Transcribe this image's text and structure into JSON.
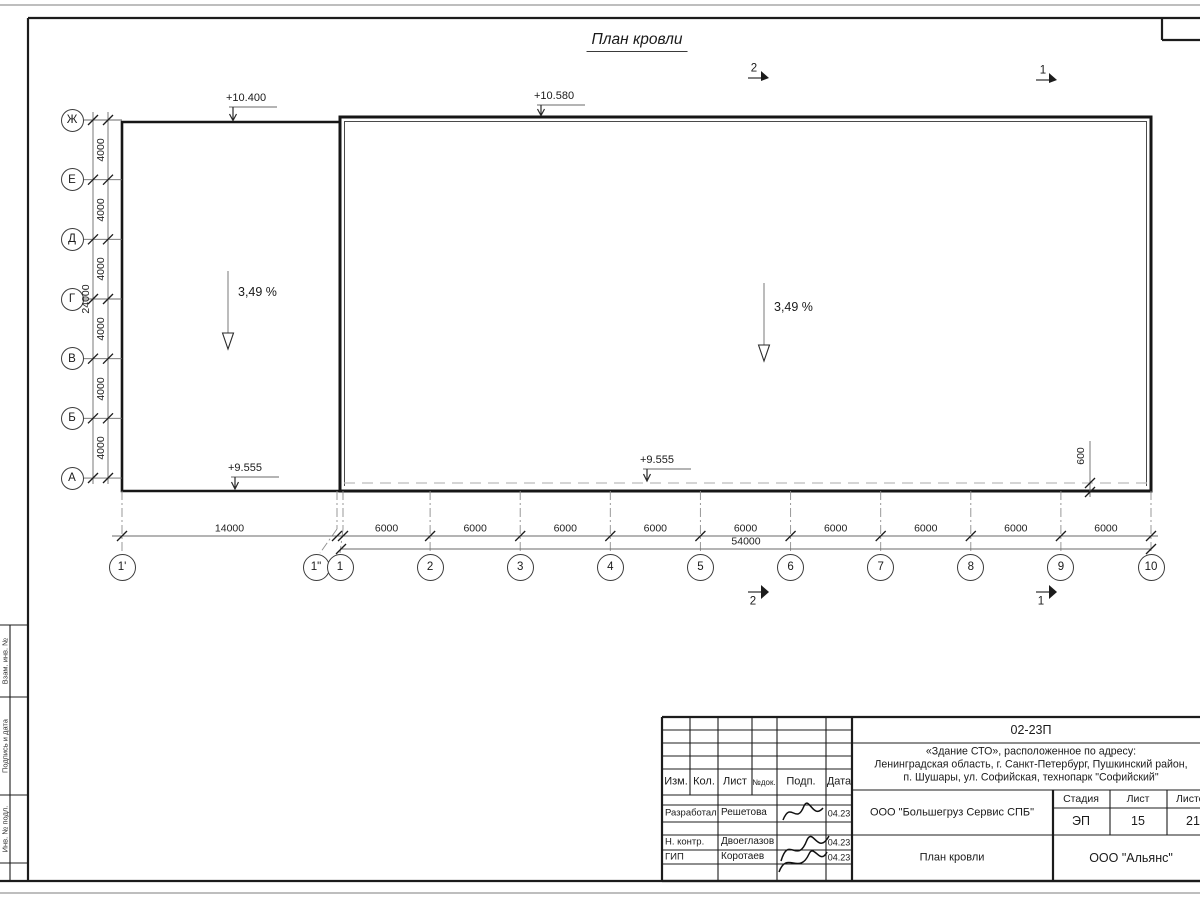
{
  "drawing": {
    "title": "План кровли",
    "slope_label": "3,49 %",
    "elevation_top_left": "+10.400",
    "elevation_top_right": "+10.580",
    "elevation_bottom_left": "+9.555",
    "elevation_bottom_right": "+9.555",
    "parapet_dim": "600",
    "section_mark_2": "2",
    "section_mark_1": "1",
    "row_axes": [
      "Ж",
      "Е",
      "Д",
      "Г",
      "В",
      "Б",
      "А"
    ],
    "col_axes": [
      "1'",
      "1\"",
      "1",
      "2",
      "3",
      "4",
      "5",
      "6",
      "7",
      "8",
      "9",
      "10"
    ],
    "v_spans": [
      "4000",
      "4000",
      "4000",
      "4000",
      "4000",
      "4000"
    ],
    "v_total": "24000",
    "h_first": "14000",
    "h_spans": [
      "6000",
      "6000",
      "6000",
      "6000",
      "6000",
      "6000",
      "6000",
      "6000",
      "6000"
    ],
    "h_total": "54000"
  },
  "frame": {
    "side_labels": [
      "Взам. инв. №",
      "Подпись и дата",
      "Инв. № подл."
    ]
  },
  "titleblock": {
    "code": "02-23П",
    "address_lines": [
      "«Здание СТО», расположенное по адресу:",
      "Ленинградская область, г. Санкт-Петербург, Пушкинский район,",
      "п. Шушары, ул. Софийская, технопарк \"Софийский\""
    ],
    "header_cols": [
      "Изм.",
      "Кол.",
      "Лист",
      "№док.",
      "Подп.",
      "Дата"
    ],
    "rows": [
      {
        "role": "Разработал",
        "name": "Решетова",
        "date": "04.23"
      },
      {
        "role": "Н. контр.",
        "name": "Двоеглазов",
        "date": "04.23"
      },
      {
        "role": "ГИП",
        "name": "Коротаев",
        "date": "04.23"
      }
    ],
    "company": "ООО \"Большегруз Сервис СПБ\"",
    "sheet_title": "План кровли",
    "org": "ООО \"Альянс\"",
    "stage_header": [
      "Стадия",
      "Лист",
      "Листов"
    ],
    "stage_values": [
      "ЭП",
      "15",
      "21"
    ]
  }
}
